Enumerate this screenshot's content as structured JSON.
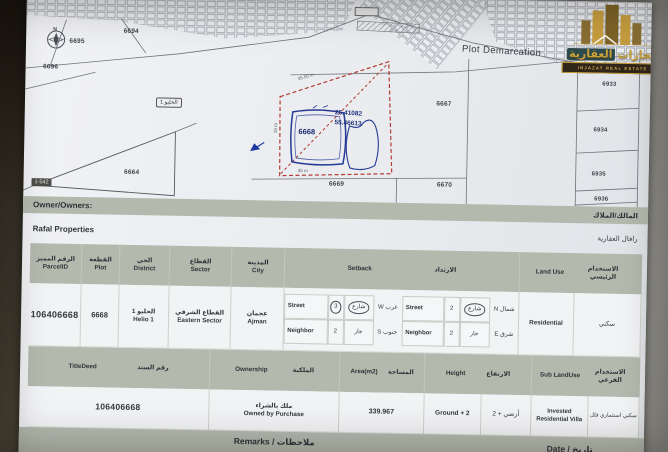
{
  "map": {
    "title": "Plot Demarcation",
    "compass_n": "N",
    "district_tag": "الحليو 1",
    "sheet_tag": "1-542",
    "subject_plot": "6668",
    "coord_lat": "25.41082",
    "coord_lng": "55.46613",
    "meas_top": "35.55 m",
    "meas_left": "25 m",
    "meas_bottom": "35 m",
    "plots": [
      {
        "label": "6694"
      },
      {
        "label": "6695"
      },
      {
        "label": "6696"
      },
      {
        "label": "6664"
      },
      {
        "label": "6667"
      },
      {
        "label": "6669"
      },
      {
        "label": "6670"
      },
      {
        "label": "6933"
      },
      {
        "label": "6934"
      },
      {
        "label": "6935"
      },
      {
        "label": "6936"
      }
    ]
  },
  "logo": {
    "name_ar_1": "انجازات",
    "name_ar_2": "العقارية",
    "name_en": "INJAZAT REAL ESTATE"
  },
  "owner": {
    "label_en": "Owner/Owners:",
    "label_ar": "المالك/الملاك",
    "value_en": "Rafal Properties",
    "value_ar": "رافال العقارية"
  },
  "table1": {
    "headers": {
      "parcel_ar": "الرقم المميز",
      "parcel_en": "ParcelID",
      "plot_ar": "القطعة",
      "plot_en": "Plot",
      "district_ar": "الحي",
      "district_en": "District",
      "sector_ar": "القطاع",
      "sector_en": "Sector",
      "city_ar": "المدينة",
      "city_en": "City",
      "setback_en": "Setback",
      "setback_ar": "الارتداد",
      "landuse_en": "Land Use",
      "landuse_ar": "الاستخدام الرئيسي"
    },
    "row": {
      "parcel_id": "106406668",
      "plot": "6668",
      "district_ar": "الحليو 1",
      "district_en": "Helio 1",
      "sector_ar": "القطاع الشرقي",
      "sector_en": "Eastern Sector",
      "city_ar": "عجمان",
      "city_en": "Ajman",
      "landuse_en": "Residential",
      "landuse_ar": "سكني",
      "setback": {
        "r1": {
          "t1": "Street",
          "v1": "3",
          "m1": "شارع",
          "d1": "غرب W",
          "t2": "Street",
          "v2": "2",
          "m2": "شارع",
          "d2": "شمال N"
        },
        "r2": {
          "t1": "Neighbor",
          "v1": "2",
          "m1": "جار",
          "d1": "جنوب S",
          "t2": "Neighbor",
          "v2": "2",
          "m2": "جار",
          "d2": "شرق E"
        }
      }
    }
  },
  "table2": {
    "headers": {
      "titledeed_en": "TitleDeed",
      "titledeed_ar": "رقم السند",
      "ownership_en": "Ownership",
      "ownership_ar": "الملكية",
      "area_en": "Area(m2)",
      "area_ar": "المساحة",
      "height_en": "Height",
      "height_ar": "الارتفاع",
      "sublanduse_en": "Sub LandUse",
      "sublanduse_ar": "الاستخدام الفرعي"
    },
    "row": {
      "titledeed": "106406668",
      "ownership_ar": "ملك بالشراء",
      "ownership_en": "Owned by Purchase",
      "area": "339.967",
      "height_en": "Ground + 2",
      "height_ar": "أرضي + 2",
      "sublanduse_en": "Invested Residential Villa",
      "sublanduse_ar": "سكني استثماري فلل"
    }
  },
  "footer": {
    "remarks": "Remarks / ملاحظات",
    "date": "Date / تاريخ"
  }
}
